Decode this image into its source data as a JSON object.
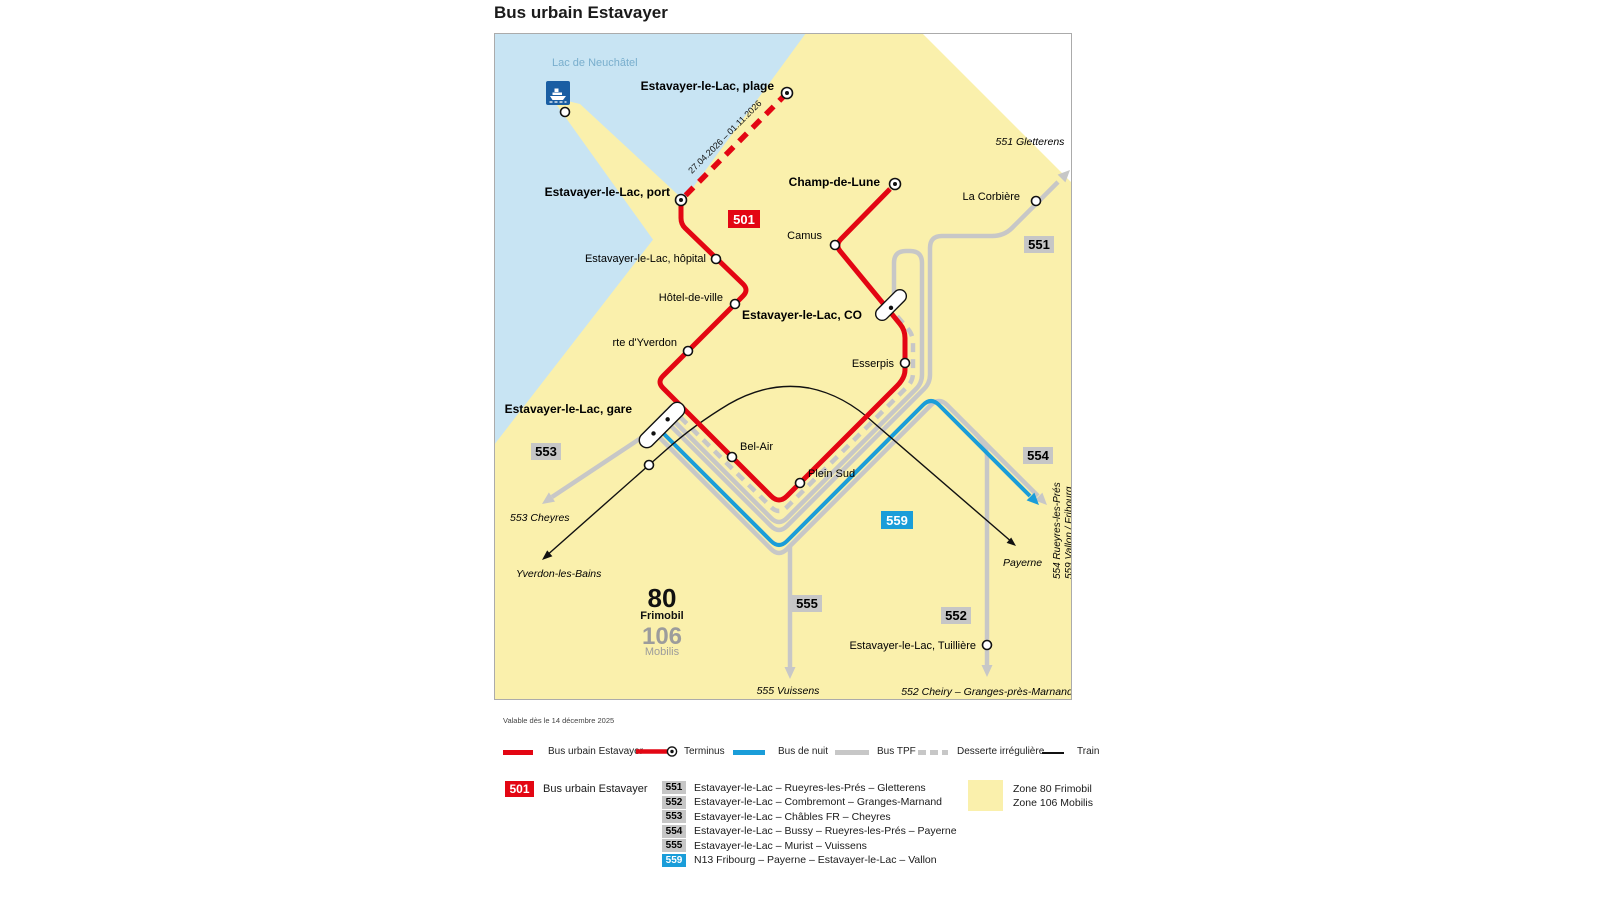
{
  "title": "Bus urbain Estavayer",
  "validity": "Valable dès le 14 décembre 2025",
  "map": {
    "lake_label": "Lac de Neuchâtel",
    "seasonal_note": "27.04.2026 – 01.11.2026",
    "labels": {
      "plage": "Estavayer-le-Lac, plage",
      "port": "Estavayer-le-Lac, port",
      "hopital": "Estavayer-le-Lac, hôpital",
      "hotel_de_ville": "Hôtel-de-ville",
      "rte_yverdon": "rte d'Yverdon",
      "gare": "Estavayer-le-Lac, gare",
      "bel_air": "Bel-Air",
      "plein_sud": "Plein Sud",
      "esserpis": "Esserpis",
      "co": "Estavayer-le-Lac, CO",
      "camus": "Camus",
      "champ_de_lune": "Champ-de-Lune",
      "la_corbiere": "La Corbière",
      "tuilliere": "Estavayer-le-Lac, Tuillière"
    },
    "badges": {
      "b501": "501",
      "b551": "551",
      "b552": "552",
      "b553": "553",
      "b554": "554",
      "b555": "555",
      "b559": "559"
    },
    "destinations": {
      "gletterens": "551  Gletterens",
      "cheyres": "553  Cheyres",
      "yverdon": "Yverdon-les-Bains",
      "payerne": "Payerne",
      "vuissens": "555  Vuissens",
      "cheiry": "552  Cheiry – Granges-près-Marnand",
      "rueyres": "554  Rueyres-les-Prés",
      "vallon": "559  Vallon / Fribourg"
    },
    "zones": {
      "z80": "80",
      "z80_name": "Frimobil",
      "z106": "106",
      "z106_name": "Mobilis"
    }
  },
  "legend": {
    "line_types": [
      {
        "label": "Bus urbain Estavayer"
      },
      {
        "label": "Terminus"
      },
      {
        "label": "Bus de nuit"
      },
      {
        "label": "Bus TPF"
      },
      {
        "label": "Desserte irrégulière"
      },
      {
        "label": "Train"
      }
    ],
    "route_501": {
      "number": "501",
      "name": "Bus urbain Estavayer"
    },
    "routes": [
      {
        "number": "551",
        "name": "Estavayer-le-Lac – Rueyres-les-Prés – Gletterens"
      },
      {
        "number": "552",
        "name": "Estavayer-le-Lac – Combremont – Granges-Marnand"
      },
      {
        "number": "553",
        "name": "Estavayer-le-Lac – Châbles FR – Cheyres"
      },
      {
        "number": "554",
        "name": "Estavayer-le-Lac – Bussy – Rueyres-les-Prés – Payerne"
      },
      {
        "number": "555",
        "name": "Estavayer-le-Lac – Murist – Vuissens"
      },
      {
        "number": "559",
        "name": "N13 Fribourg – Payerne – Estavayer-le-Lac – Vallon"
      }
    ],
    "zone_entries": [
      {
        "label": "Zone 80 Frimobil"
      },
      {
        "label": "Zone 106 Mobilis"
      }
    ]
  },
  "colors": {
    "red": "#E30613",
    "blue": "#1A9DD9",
    "gray_line": "#C7C7C7",
    "zone_yellow": "#FAF0AC",
    "lake": "#C8E4F3",
    "ferry_blue": "#1A5EA3"
  }
}
